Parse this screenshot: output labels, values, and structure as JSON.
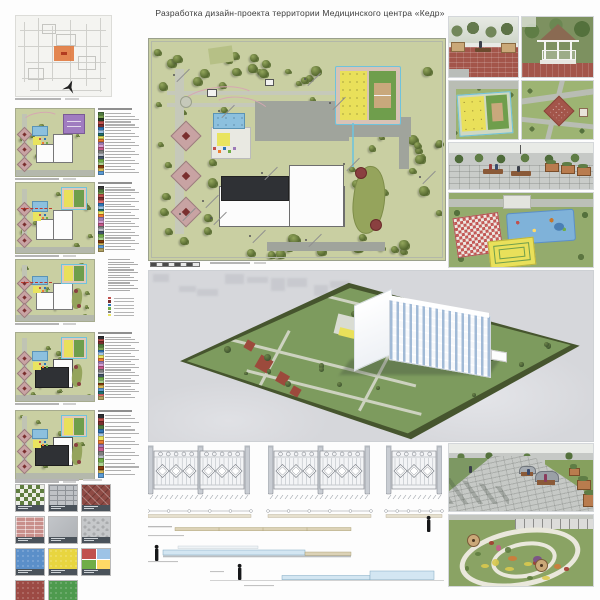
{
  "board": {
    "title": "Разработка дизайн-проекта территории Медицинского центра «Кедр»"
  },
  "palette": {
    "plan_green": "#c9cfa2",
    "tree_dark": "#55682f",
    "tree_light": "#93a65c",
    "road_gray": "#c6c9ba",
    "plaza_gray": "#a0a49c",
    "building_white": "#fcfcfc",
    "building_dark": "#2f3135",
    "court_yellow": "#e9e05a",
    "court_green": "#6f9e4c",
    "court_tan": "#c9a87c",
    "court_blue_edge": "#6fc3dc",
    "pool_blue": "#8cc0de",
    "diamond_pink": "#c8a3a3",
    "diamond_red": "#7a2e2e",
    "purple_zone": "#a07cc0",
    "sports_surround": "#d8c3b6",
    "sgarden_green": "#95a45c",
    "gazebo_red": "#8a4040",
    "render_ground": "#d6d7db",
    "render_site_green": "#7d9b5e",
    "render_site_border": "#46552e",
    "paving_red": "#a3554a",
    "highlight_orange": "#e0763a",
    "section_blue": "#d3e6f2",
    "section_tan": "#dcd2b6",
    "figure_black": "#17181a"
  },
  "legends": {
    "l1": [
      "#4f7a3f",
      "#7aa351",
      "#243a22",
      "#c0504d",
      "#7a2e2e",
      "#2e75b6",
      "#9dc3e6",
      "#1f6f6f",
      "#e9e45f",
      "#ed7d31",
      "#9d7bb8",
      "#d59fd5",
      "#c55a8a",
      "#7f7f7f",
      "#b9bdc4",
      "#44546a",
      "#70ad47",
      "#a9d18e",
      "#843c0c",
      "#d6b656",
      "#5b9bd5"
    ],
    "l2": [
      "#3b3b3b",
      "#4f7a3f",
      "#7aa351",
      "#c0504d",
      "#7a2e2e",
      "#e36c6c",
      "#2e75b6",
      "#9dc3e6",
      "#1f6f6f",
      "#e9e45f",
      "#ed7d31",
      "#9d7bb8",
      "#d59fd5",
      "#c55a8a",
      "#7f7f7f",
      "#b9bdc4",
      "#44546a",
      "#70ad47",
      "#a9d18e",
      "#843c0c",
      "#d6b656",
      "#5b9bd5",
      "#b0a060"
    ],
    "l3": [
      "#c0504d",
      "#7a2e2e",
      "#2e75b6",
      "#70ad47",
      "#7f7f7f",
      "#e9e45f"
    ],
    "l4": [
      "#2f3135",
      "#c0504d",
      "#7a2e2e",
      "#4f7a3f",
      "#7aa351",
      "#2e75b6",
      "#9dc3e6",
      "#e9e45f",
      "#ed7d31",
      "#9d7bb8",
      "#d59fd5",
      "#c55a8a",
      "#7f7f7f",
      "#b9bdc4",
      "#44546a",
      "#70ad47",
      "#a9d18e",
      "#843c0c",
      "#d6b656",
      "#5b9bd5",
      "#1f6f6f",
      "#e36c6c",
      "#b0a060"
    ],
    "l5": [
      "#2f3135",
      "#c0504d",
      "#7a2e2e",
      "#4f7a3f",
      "#2e75b6",
      "#9dc3e6",
      "#e9e45f",
      "#ed7d31",
      "#9d7bb8",
      "#c55a8a",
      "#7f7f7f",
      "#b9bdc4",
      "#70ad47",
      "#a9d18e",
      "#843c0c",
      "#d6b656",
      "#5b9bd5"
    ]
  },
  "left_plans": [
    {
      "top": 108,
      "h": 67,
      "building": "white",
      "features": [
        "purple",
        "kids",
        "curve",
        "diamonds"
      ],
      "legend": "l1"
    },
    {
      "top": 182,
      "h": 70,
      "building": "white",
      "features": [
        "court",
        "kids",
        "diamonds",
        "dash"
      ],
      "legend": "l2"
    },
    {
      "top": 259,
      "h": 61,
      "building": "white",
      "features": [
        "court",
        "kids",
        "sgarden",
        "diamonds",
        "dash"
      ],
      "legend": "para"
    },
    {
      "top": 332,
      "h": 68,
      "building": "dark",
      "features": [
        "court",
        "kids",
        "sgarden",
        "diamonds"
      ],
      "legend": "l4"
    },
    {
      "top": 410,
      "h": 68,
      "building": "dark",
      "features": [
        "court",
        "kids",
        "sgarden",
        "diamonds"
      ],
      "legend": "l5"
    }
  ],
  "swatches": [
    {
      "pattern": "checker",
      "colors": [
        "#5f7d3f",
        "#eceee6"
      ]
    },
    {
      "pattern": "ipaver",
      "colors": [
        "#bfc2c6",
        "#8f9398"
      ]
    },
    {
      "pattern": "herringbone",
      "colors": [
        "#8e4a44",
        "#a45a50"
      ]
    },
    {
      "pattern": "brick",
      "colors": [
        "#c98f8b",
        "#b97b77"
      ]
    },
    {
      "pattern": "plain",
      "colors": [
        "#c2c5c9",
        "#b0b3b7"
      ]
    },
    {
      "pattern": "cobble",
      "colors": [
        "#c6c8ca",
        "#a9abad"
      ]
    },
    {
      "pattern": "rubber",
      "colors": [
        "#5b8fc9"
      ]
    },
    {
      "pattern": "rubber",
      "colors": [
        "#e8d53f"
      ]
    },
    {
      "pattern": "quad",
      "colors": [
        "#c0504d",
        "#9dc3e6",
        "#70ad47",
        "#ffd966"
      ]
    },
    {
      "pattern": "rubber",
      "colors": [
        "#9c4a44"
      ]
    },
    {
      "pattern": "rubber",
      "colors": [
        "#4e9a4e"
      ]
    }
  ],
  "fence_groups": [
    {
      "panels": 2
    },
    {
      "panels": 2
    },
    {
      "panels": 1
    }
  ]
}
